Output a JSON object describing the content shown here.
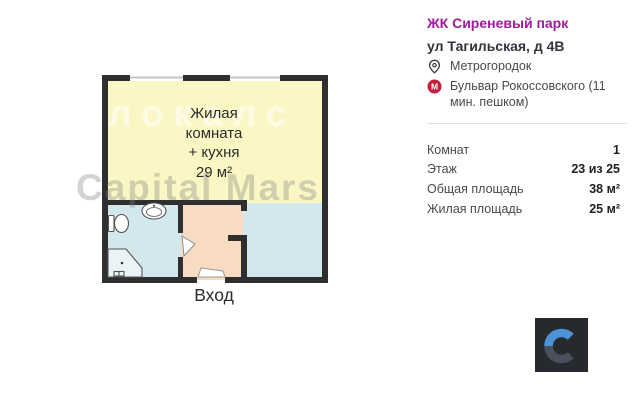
{
  "floor_plan": {
    "room": {
      "line1": "Жилая",
      "line2": "комната",
      "line3": "+ кухня",
      "area": "29 м²"
    },
    "entrance_label": "Вход",
    "watermarks": {
      "primary": "локалс",
      "secondary": "Capital Mars"
    },
    "colors": {
      "living_room": "#fbf7c5",
      "wet_zone": "#d3e8ec",
      "hallway": "#f8dcc2",
      "wall": "#2f2f2f"
    }
  },
  "details": {
    "complex_name": "ЖК Сиреневый парк",
    "complex_color": "#a21a9e",
    "address": "ул Тагильская, д 4В",
    "district": "Метрогородок",
    "metro_station": "Бульвар Рокоссовского (11 мин. пешком)",
    "metro_color": "#c51f3c",
    "rows": [
      {
        "label": "Комнат",
        "value": "1"
      },
      {
        "label": "Этаж",
        "value": "23 из 25"
      },
      {
        "label": "Общая площадь",
        "value": "38 м²"
      },
      {
        "label": "Жилая площадь",
        "value": "25 м²"
      }
    ]
  },
  "logo": {
    "letter": "C"
  }
}
